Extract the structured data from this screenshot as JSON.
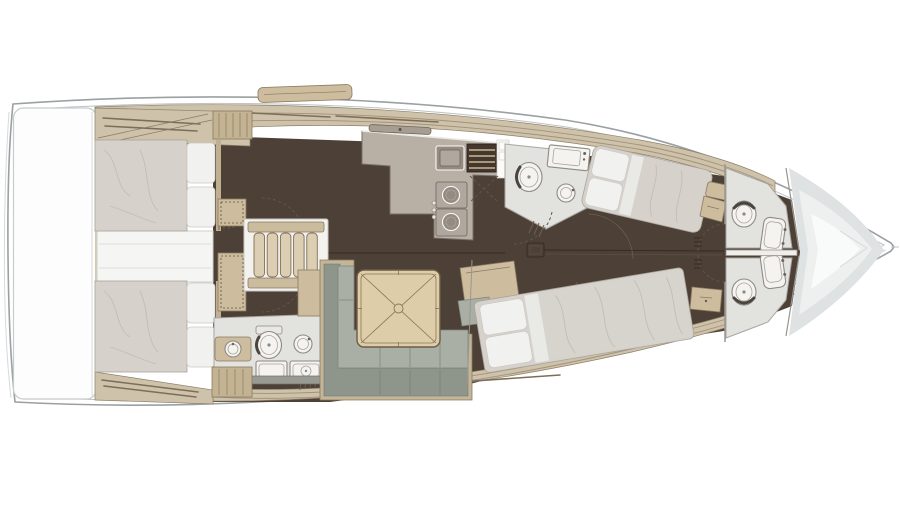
{
  "title": "Sailing yacht interior layout plan (top view, 4 cabins / 4 heads)",
  "colors": {
    "bg": "#ffffff",
    "hull_line": "#9aa0a3",
    "hull_inner": "#bdc2c4",
    "hull_faint": "#d6d9da",
    "floor": "#4d4036",
    "floor_seam": "#342b24",
    "deck": "#cec2aa",
    "deck_seam": "#a2927a",
    "deck_edge": "#8d8068",
    "rod": "#7c6e58",
    "wood": "#cdbd9e",
    "wood_dark": "#8a7a61",
    "wardrobe": "#c3b392",
    "duvet": "#d6d2cb",
    "pillow": "#f1f1ef",
    "wrinkle": "#c2beb7",
    "mattress_edge": "#a8a49d",
    "sofa_seat": "#a9afa5",
    "sofa_back": "#8e968c",
    "sofa_frame": "#c3b597",
    "table": "#decda9",
    "table_line": "#8a7557",
    "counter": "#b8afa5",
    "sink": "#948b81",
    "icebox": "#44382e",
    "slat": "#b7a584",
    "bath_floor": "#e2e2df",
    "fixture": "#f4f3f0",
    "fixture_line": "#8e8a84",
    "platform": "#fdfdfd",
    "platform_line": "#c7cbcb",
    "bow_deck": "#dfe2e2",
    "arc": "#5f564c",
    "wall": "#9a968f",
    "tread": "#dbceb2"
  },
  "regions": [
    {
      "id": "stern-swim-platform",
      "label": "stern swim platform"
    },
    {
      "id": "aft-cabin-port",
      "label": "aft cabin port with double berth"
    },
    {
      "id": "aft-cabin-starboard",
      "label": "aft cabin starboard with double berth"
    },
    {
      "id": "companionway",
      "label": "companionway steps"
    },
    {
      "id": "engine-compartment",
      "label": "engine compartment"
    },
    {
      "id": "aft-head",
      "label": "aft head with shower"
    },
    {
      "id": "galley",
      "label": "L-shaped galley"
    },
    {
      "id": "mid-head",
      "label": "amidships head"
    },
    {
      "id": "salon",
      "label": "salon with L-sofa and table"
    },
    {
      "id": "forward-cabin-port",
      "label": "forward cabin port"
    },
    {
      "id": "forward-cabin-starboard",
      "label": "forward cabin starboard"
    },
    {
      "id": "bow-head-port",
      "label": "bow head port"
    },
    {
      "id": "bow-head-starboard",
      "label": "bow head starboard"
    },
    {
      "id": "forepeak",
      "label": "forepeak sail locker"
    }
  ]
}
